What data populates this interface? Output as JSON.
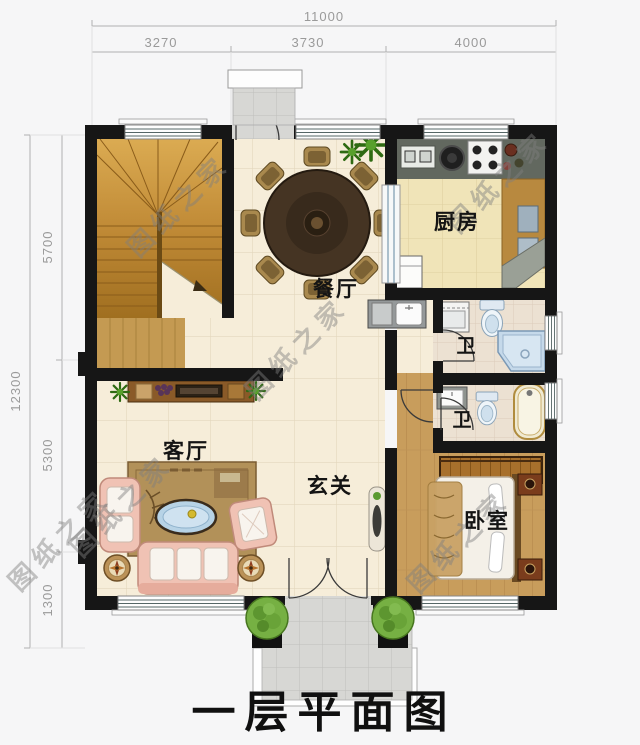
{
  "title": "一层平面图",
  "watermark": "图纸之家",
  "dimensions": {
    "top": {
      "total": "11000",
      "segments": [
        "3270",
        "3730",
        "4000"
      ]
    },
    "left": {
      "total": "12300",
      "segments": [
        "5700",
        "5300",
        "1300"
      ]
    }
  },
  "rooms": {
    "dining": "餐厅",
    "kitchen": "厨房",
    "bath_upper": "卫",
    "bath_lower": "卫",
    "living": "客厅",
    "foyer": "玄关",
    "bedroom": "卧室"
  },
  "colors": {
    "wall": "#161616",
    "tile_cream": "#f6edd9",
    "tile_kitchen": "#f0e4b8",
    "wood": "#c89d5c",
    "stair_wood": "#c08a36",
    "water_fixture": "#c5d9ea",
    "sofa_pink": "#f0c2b4"
  }
}
